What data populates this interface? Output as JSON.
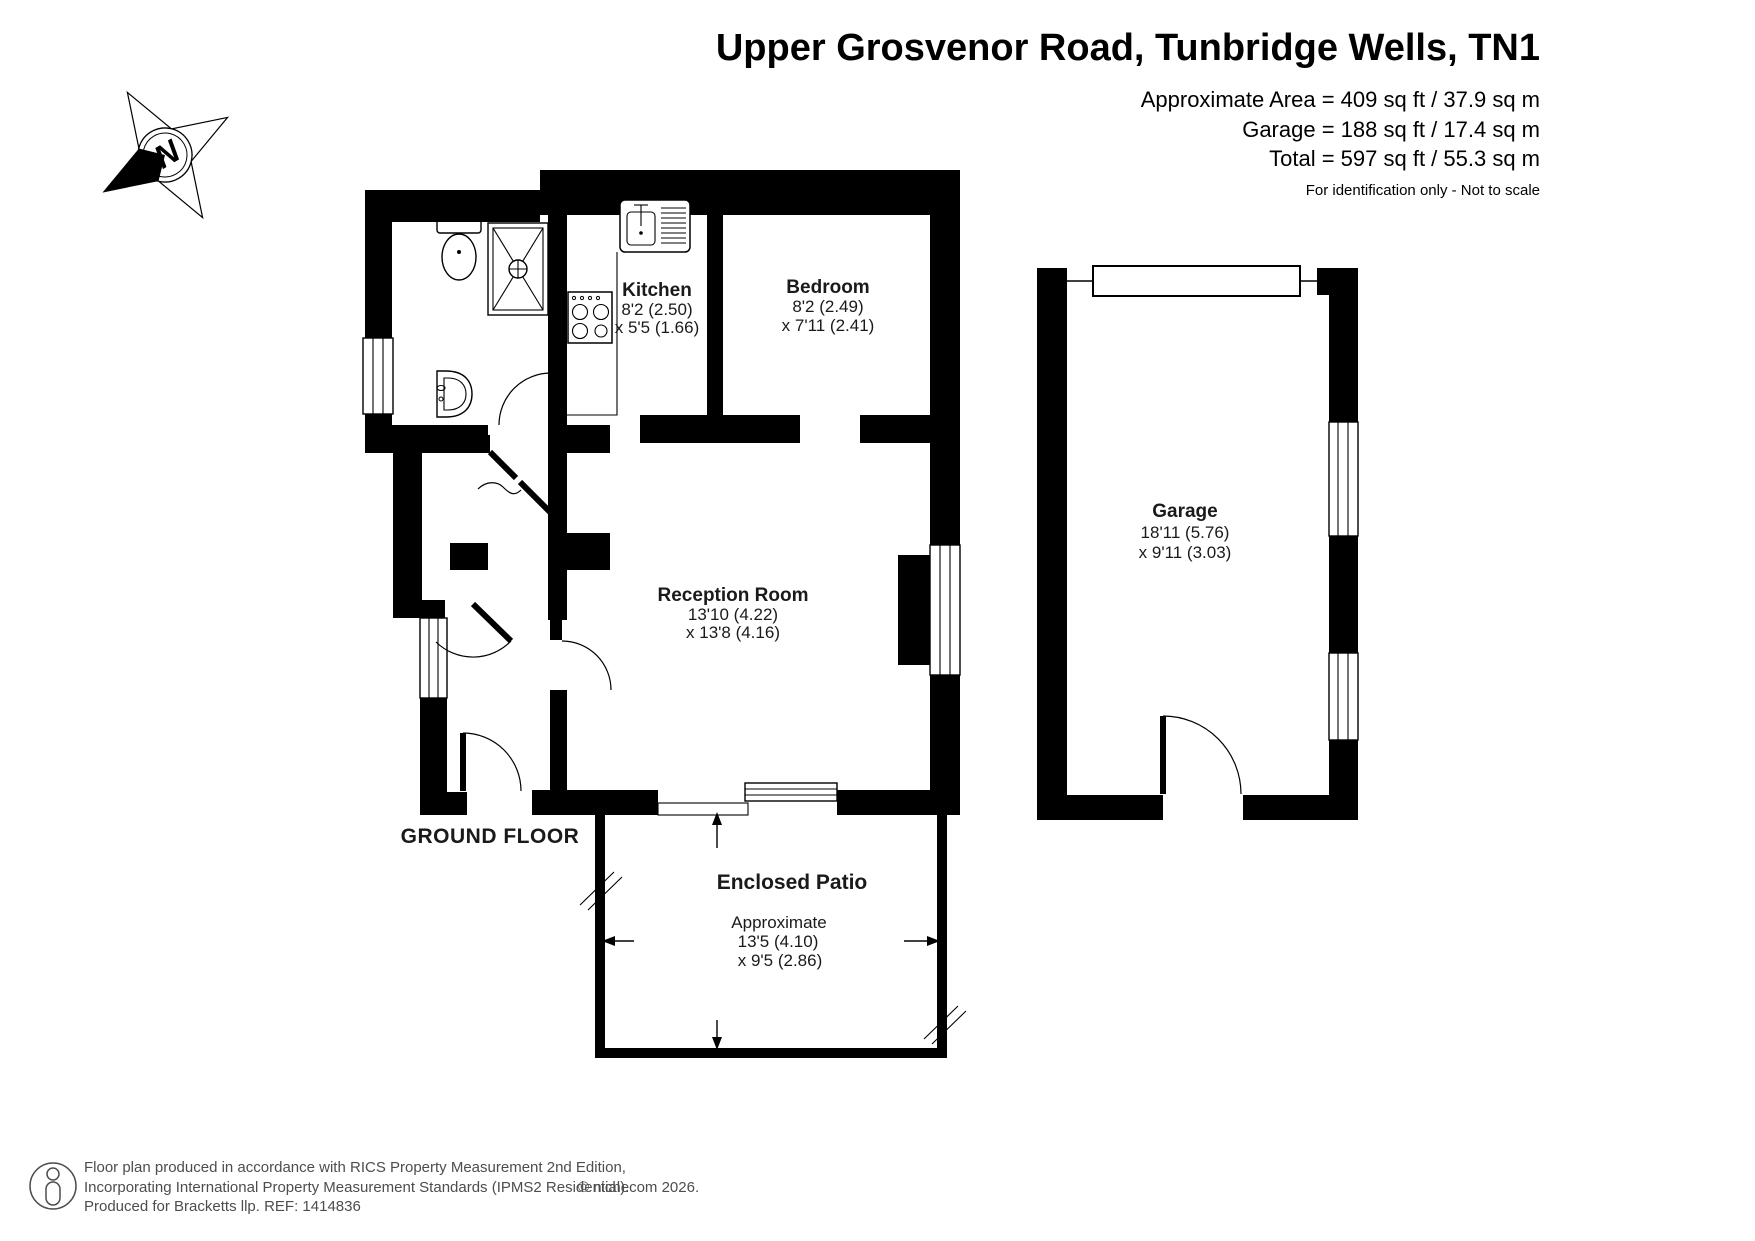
{
  "header": {
    "title": "Upper Grosvenor Road, Tunbridge Wells, TN1",
    "area_line1": "Approximate Area = 409 sq ft / 37.9 sq m",
    "area_line2": "Garage = 188 sq ft / 17.4 sq m",
    "area_line3": "Total = 597 sq ft / 55.3 sq m",
    "note": "For identification only - Not to scale"
  },
  "compass": {
    "north": "N"
  },
  "rooms": {
    "kitchen": {
      "name": "Kitchen",
      "dim1": "8'2 (2.50)",
      "dim2": "x 5'5 (1.66)"
    },
    "bedroom": {
      "name": "Bedroom",
      "dim1": "8'2 (2.49)",
      "dim2": "x 7'11 (2.41)"
    },
    "reception": {
      "name": "Reception Room",
      "dim1": "13'10 (4.22)",
      "dim2": "x 13'8 (4.16)"
    },
    "garage": {
      "name": "Garage",
      "dim1": "18'11 (5.76)",
      "dim2": "x 9'11 (3.03)"
    },
    "patio": {
      "name": "Enclosed Patio",
      "qualifier": "Approximate",
      "dim1": "13'5 (4.10)",
      "dim2": "x 9'5 (2.86)"
    }
  },
  "floor_label": "GROUND FLOOR",
  "footer": {
    "line1": "Floor plan produced in accordance with RICS Property Measurement 2nd Edition,",
    "line2": "Incorporating International Property Measurement Standards (IPMS2 Residential).",
    "copyright": "© nichecom 2026.",
    "line3": "Produced for Bracketts llp.   REF:  1414836"
  },
  "colors": {
    "wall": "#000000",
    "label": "#1a1a1a",
    "footer_text": "#4d4d4d"
  }
}
